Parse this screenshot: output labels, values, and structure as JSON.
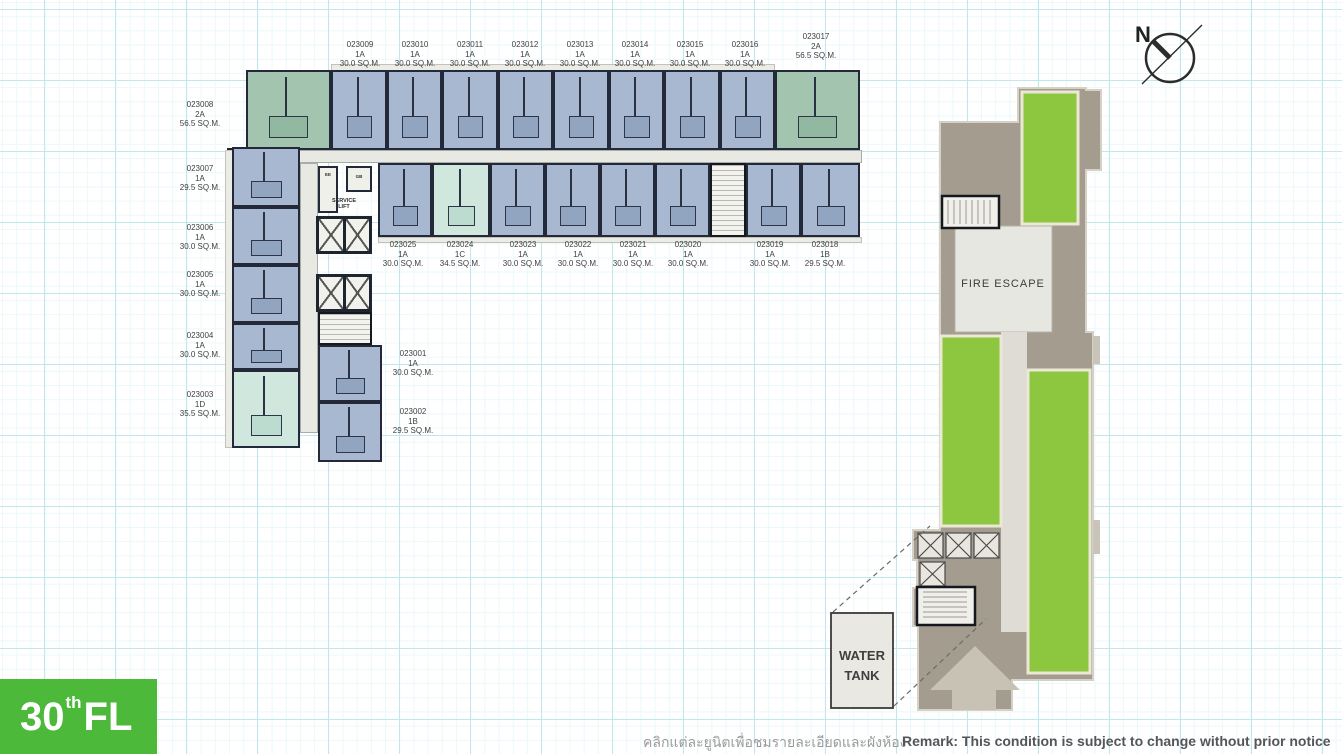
{
  "floor_badge": {
    "floor_number": "30",
    "floor_suffix": "th",
    "floor_label": "FL"
  },
  "compass": {
    "north_label": "N"
  },
  "footer": {
    "thai_note": "คลิกแต่ละยูนิตเพื่อชมรายละเอียดและผังห้อง",
    "remark": "Remark: This condition is subject to change without prior notice"
  },
  "core": {
    "ee": "EE",
    "gb": "GB",
    "service_lift_line1": "SERVICE",
    "service_lift_line2": "LIFT"
  },
  "tower": {
    "fire_escape": "FIRE ESCAPE",
    "water_tank_line1": "WATER",
    "water_tank_line2": "TANK"
  },
  "labels": {
    "top": [
      {
        "id": "023009",
        "type": "1A",
        "area": "30.0 SQ.M."
      },
      {
        "id": "023010",
        "type": "1A",
        "area": "30.0 SQ.M."
      },
      {
        "id": "023011",
        "type": "1A",
        "area": "30.0 SQ.M."
      },
      {
        "id": "023012",
        "type": "1A",
        "area": "30.0 SQ.M."
      },
      {
        "id": "023013",
        "type": "1A",
        "area": "30.0 SQ.M."
      },
      {
        "id": "023014",
        "type": "1A",
        "area": "30.0 SQ.M."
      },
      {
        "id": "023015",
        "type": "1A",
        "area": "30.0 SQ.M."
      },
      {
        "id": "023016",
        "type": "1A",
        "area": "30.0 SQ.M."
      },
      {
        "id": "023017",
        "type": "2A",
        "area": "56.5 SQ.M."
      }
    ],
    "left": [
      {
        "id": "023008",
        "type": "2A",
        "area": "56.5 SQ.M."
      },
      {
        "id": "023007",
        "type": "1A",
        "area": "29.5 SQ.M."
      },
      {
        "id": "023006",
        "type": "1A",
        "area": "30.0 SQ.M."
      },
      {
        "id": "023005",
        "type": "1A",
        "area": "30.0 SQ.M."
      },
      {
        "id": "023004",
        "type": "1A",
        "area": "30.0 SQ.M."
      },
      {
        "id": "023003",
        "type": "1D",
        "area": "35.5 SQ.M."
      }
    ],
    "mid": [
      {
        "id": "023025",
        "type": "1A",
        "area": "30.0 SQ.M."
      },
      {
        "id": "023024",
        "type": "1C",
        "area": "34.5 SQ.M."
      },
      {
        "id": "023023",
        "type": "1A",
        "area": "30.0 SQ.M."
      },
      {
        "id": "023022",
        "type": "1A",
        "area": "30.0 SQ.M."
      },
      {
        "id": "023021",
        "type": "1A",
        "area": "30.0 SQ.M."
      },
      {
        "id": "023020",
        "type": "1A",
        "area": "30.0 SQ.M."
      },
      {
        "id": "023019",
        "type": "1A",
        "area": "30.0 SQ.M."
      },
      {
        "id": "023018",
        "type": "1B",
        "area": "29.5 SQ.M."
      }
    ],
    "inner": [
      {
        "id": "023001",
        "type": "1A",
        "area": "30.0 SQ.M."
      },
      {
        "id": "023002",
        "type": "1B",
        "area": "29.5 SQ.M."
      }
    ]
  },
  "colors": {
    "badge_green": "#4cb93b",
    "garden_green": "#8dc63f",
    "unit_blue": "#a7b8d0",
    "unit_teal": "#cfe7dd",
    "unit_sage": "#a3c5b0",
    "tower_taupe": "#a49d8f",
    "grid_cyan": "#bfe7ec"
  }
}
